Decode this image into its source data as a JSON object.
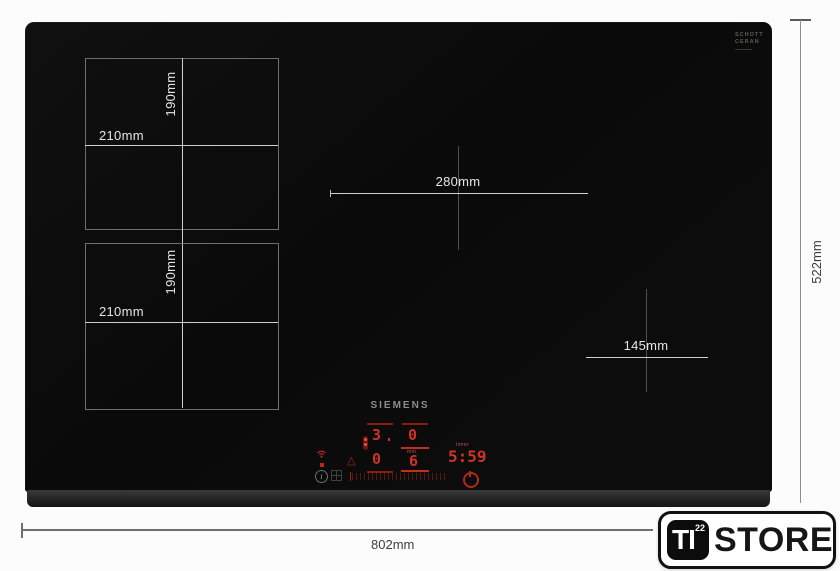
{
  "dims": {
    "zone_top_height": "190mm",
    "zone_top_width": "210mm",
    "zone_bottom_height": "190mm",
    "zone_bottom_width": "210mm",
    "zone_center_width": "280mm",
    "zone_right_width": "145mm",
    "overall_width": "802mm",
    "overall_depth": "522mm"
  },
  "hob": {
    "brand": "SIEMENS",
    "glass_logo": {
      "line1": "SCHOTT",
      "line2": "CERAN"
    },
    "control_panel": {
      "zone_displays": {
        "rear_left": "3",
        "rear_right": "0",
        "front_left": "0",
        "front_right": "6",
        "front_right_unit": "min"
      },
      "timer_label": "timer",
      "timer_value": "5:59",
      "info_glyph": "i",
      "warning_glyph": "△"
    }
  },
  "store_badge": {
    "monogram": "TI",
    "superscript": "22",
    "text": "STORE"
  },
  "colors": {
    "display_red": "#cf3324",
    "dim_red": "#8a1d12",
    "glass_black": "#0b0b0b",
    "zone_line_gray": "#6e6e6e",
    "marker_light": "#cfcfcf",
    "background": "#fcfcfc",
    "badge_black": "#0c0c0c"
  }
}
